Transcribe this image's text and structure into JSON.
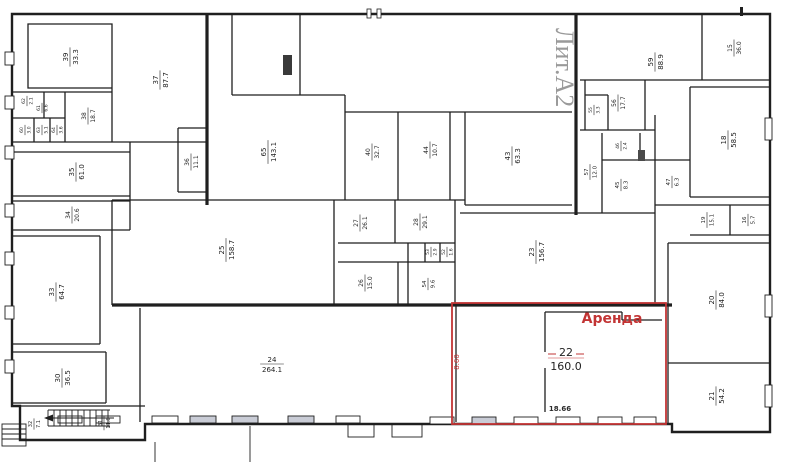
{
  "plan_title": "Поэтажный план (Лит.А2)",
  "legend": {
    "lit_label": "Лит.А2",
    "rent_label": "Аренда"
  },
  "rent": {
    "room_number": "22",
    "room_area": "160.0",
    "width_dim": "18.66",
    "height_dim": "8.60"
  },
  "colors": {
    "walls": "#1f1f1f",
    "paper": "#ffffff",
    "accent": "#c23434",
    "lit_text": "#9a9a9a",
    "window_shade": "#c9ccd6"
  },
  "rooms": [
    {
      "n": "39",
      "a": "33.3",
      "x": 70,
      "y": 57,
      "r": 1,
      "fs": 7
    },
    {
      "n": "37",
      "a": "87.7",
      "x": 160,
      "y": 80,
      "r": 1,
      "fs": 7
    },
    {
      "n": "38",
      "a": "18.7",
      "x": 88,
      "y": 116,
      "r": 1,
      "fs": 6
    },
    {
      "n": "62",
      "a": "2.1",
      "x": 27,
      "y": 101,
      "r": 1,
      "fs": 4.5
    },
    {
      "n": "61",
      "a": "6.6",
      "x": 42,
      "y": 108,
      "r": 1,
      "fs": 4.5
    },
    {
      "n": "60",
      "a": "3.0",
      "x": 25,
      "y": 130,
      "r": 1,
      "fs": 4.5
    },
    {
      "n": "63",
      "a": "5.1",
      "x": 42,
      "y": 130,
      "r": 1,
      "fs": 4.5
    },
    {
      "n": "64",
      "a": "3.6",
      "x": 57,
      "y": 130,
      "r": 1,
      "fs": 4.5
    },
    {
      "n": "35",
      "a": "61.0",
      "x": 76,
      "y": 172,
      "r": 1,
      "fs": 7
    },
    {
      "n": "34",
      "a": "20.6",
      "x": 72,
      "y": 215,
      "r": 1,
      "fs": 6
    },
    {
      "n": "33",
      "a": "64.7",
      "x": 56,
      "y": 292,
      "r": 1,
      "fs": 7
    },
    {
      "n": "30",
      "a": "36.5",
      "x": 62,
      "y": 378,
      "r": 1,
      "fs": 7
    },
    {
      "n": "32",
      "a": "7.1",
      "x": 34,
      "y": 424,
      "r": 1,
      "fs": 5
    },
    {
      "n": "31",
      "a": "11.8",
      "x": 104,
      "y": 423,
      "r": 1,
      "fs": 5
    },
    {
      "n": "36",
      "a": "11.1",
      "x": 191,
      "y": 162,
      "r": 1,
      "fs": 6
    },
    {
      "n": "65",
      "a": "143.1",
      "x": 268,
      "y": 152,
      "r": 1,
      "fs": 7
    },
    {
      "n": "25",
      "a": "158.7",
      "x": 226,
      "y": 250,
      "r": 1,
      "fs": 7
    },
    {
      "n": "27",
      "a": "26.1",
      "x": 360,
      "y": 223,
      "r": 1,
      "fs": 6
    },
    {
      "n": "28",
      "a": "29.1",
      "x": 420,
      "y": 222,
      "r": 1,
      "fs": 6
    },
    {
      "n": "26",
      "a": "15.0",
      "x": 365,
      "y": 283,
      "r": 1,
      "fs": 6
    },
    {
      "n": "54",
      "a": "9.6",
      "x": 428,
      "y": 284,
      "r": 1,
      "fs": 5.5
    },
    {
      "n": "53",
      "a": "2.9",
      "x": 431,
      "y": 252,
      "r": 1,
      "fs": 4.5
    },
    {
      "n": "52",
      "a": "1.6",
      "x": 447,
      "y": 252,
      "r": 1,
      "fs": 4.5
    },
    {
      "n": "24",
      "a": "264.1",
      "x": 272,
      "y": 364,
      "r": 0,
      "fs": 7
    },
    {
      "n": "40",
      "a": "32.7",
      "x": 372,
      "y": 152,
      "r": 1,
      "fs": 6
    },
    {
      "n": "44",
      "a": "10.7",
      "x": 430,
      "y": 150,
      "r": 1,
      "fs": 6
    },
    {
      "n": "43",
      "a": "63.3",
      "x": 512,
      "y": 156,
      "r": 1,
      "fs": 7
    },
    {
      "n": "59",
      "a": "88.9",
      "x": 655,
      "y": 62,
      "r": 1,
      "fs": 7
    },
    {
      "n": "15",
      "a": "36.0",
      "x": 734,
      "y": 48,
      "r": 1,
      "fs": 6
    },
    {
      "n": "56",
      "a": "17.7",
      "x": 618,
      "y": 103,
      "r": 1,
      "fs": 6
    },
    {
      "n": "55",
      "a": "3.3",
      "x": 594,
      "y": 110,
      "r": 1,
      "fs": 4.5
    },
    {
      "n": "57",
      "a": "12.0",
      "x": 590,
      "y": 172,
      "r": 1,
      "fs": 5.5
    },
    {
      "n": "46",
      "a": "2.4",
      "x": 621,
      "y": 146,
      "r": 1,
      "fs": 4.5
    },
    {
      "n": "45",
      "a": "8.3",
      "x": 621,
      "y": 185,
      "r": 1,
      "fs": 5.5
    },
    {
      "n": "47",
      "a": "6.3",
      "x": 672,
      "y": 182,
      "r": 1,
      "fs": 5.5
    },
    {
      "n": "18",
      "a": "58.5",
      "x": 728,
      "y": 140,
      "r": 1,
      "fs": 7
    },
    {
      "n": "19",
      "a": "15.1",
      "x": 707,
      "y": 220,
      "r": 1,
      "fs": 5.5
    },
    {
      "n": "16",
      "a": "5.7",
      "x": 748,
      "y": 220,
      "r": 1,
      "fs": 5.5
    },
    {
      "n": "20",
      "a": "84.0",
      "x": 716,
      "y": 300,
      "r": 1,
      "fs": 7
    },
    {
      "n": "21",
      "a": "54.2",
      "x": 716,
      "y": 396,
      "r": 1,
      "fs": 7
    },
    {
      "n": "23",
      "a": "156.7",
      "x": 536,
      "y": 252,
      "r": 1,
      "fs": 7
    },
    {
      "n": "22",
      "a": "160.0",
      "x": 566,
      "y": 358,
      "r": 0,
      "fs": 11,
      "red": 1
    }
  ]
}
